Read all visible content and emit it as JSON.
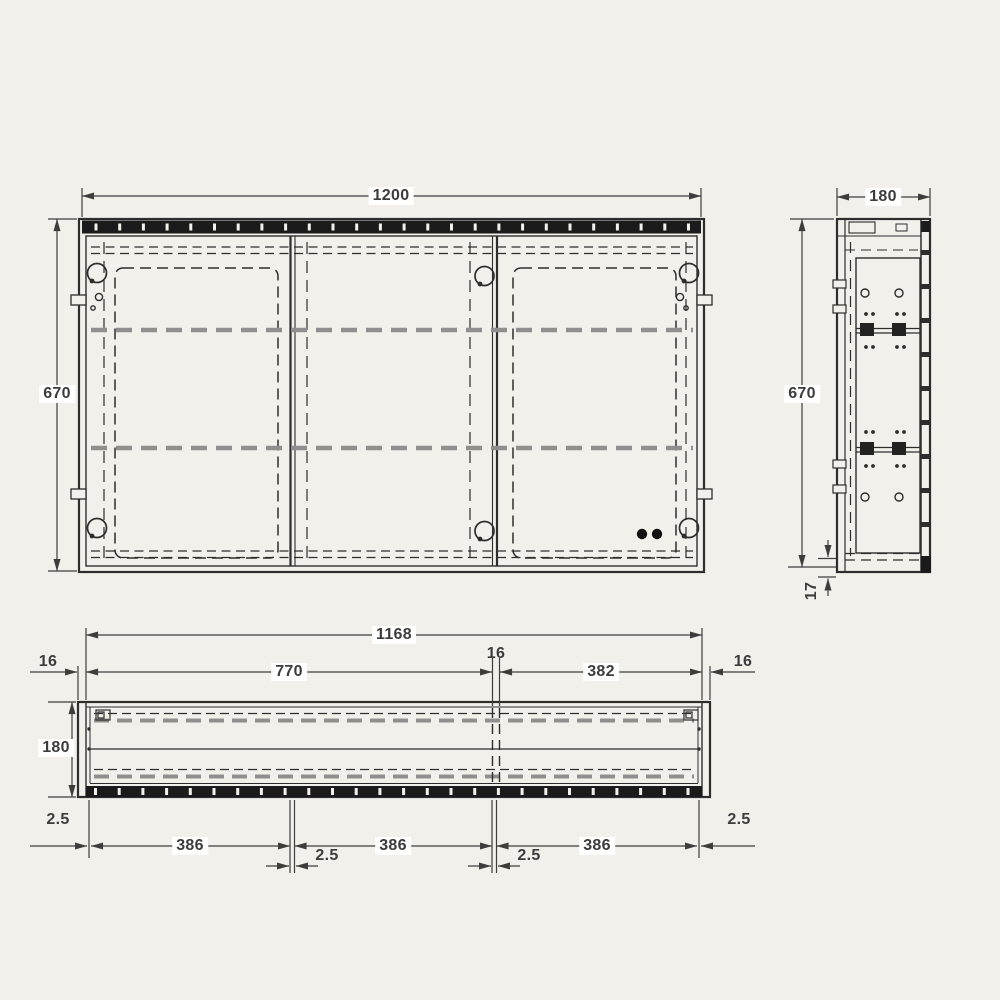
{
  "colors": {
    "background": "#f2f0ea",
    "line": "#2d2d2d",
    "dim_line": "#3d3d3d",
    "shelf_dash": "#8f8f8f",
    "led_strip": "#1b1b1b",
    "label_bg": "#ffffff"
  },
  "drawing": {
    "subject": "Mirror cabinet technical drawing - front, side and bottom views with dimensions (mm)",
    "front": {
      "view": "front elevation",
      "width": "1200",
      "height": "670"
    },
    "side": {
      "view": "side section",
      "depth": "180",
      "height": "670",
      "overhang": "17"
    },
    "plan": {
      "view": "bottom plan",
      "inner_width": "1168",
      "left_panel": "16",
      "left_compartment": "770",
      "partition": "16",
      "right_compartment": "382",
      "right_panel": "16",
      "depth": "180",
      "gap_left": "2.5",
      "door1": "386",
      "gap1": "2.5",
      "door2": "386",
      "gap2": "2.5",
      "door3": "386",
      "gap_right": "2.5"
    }
  }
}
